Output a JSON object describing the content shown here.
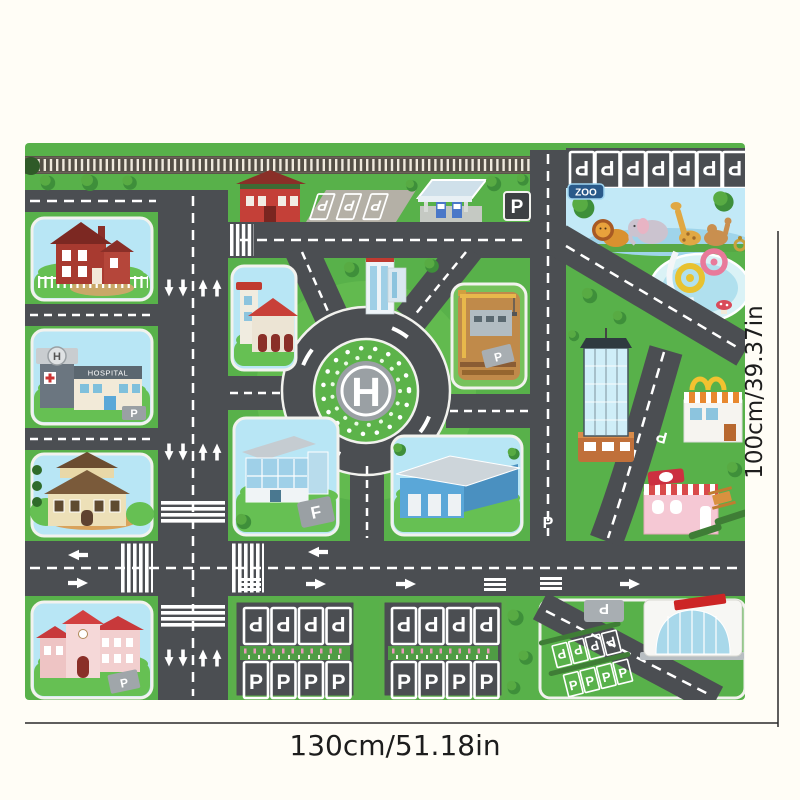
{
  "annotations": {
    "width_label": "130cm/51.18in",
    "height_label": "100cm/39.37in"
  },
  "mat": {
    "helipad_letter": "H",
    "parking_letter": "P",
    "f_pad_letter": "F",
    "hospital_sign": "HOSPITAL",
    "hospital_helipad_letter": "H",
    "zoo_sign": "ZOO",
    "colors": {
      "mat_green": "#58b14a",
      "road_gray": "#4b4e52",
      "road_marking": "#ffffff",
      "block_sky": "#b8e6f5",
      "background": "#fffdf6",
      "annotation_text": "#1d1d1d"
    }
  }
}
